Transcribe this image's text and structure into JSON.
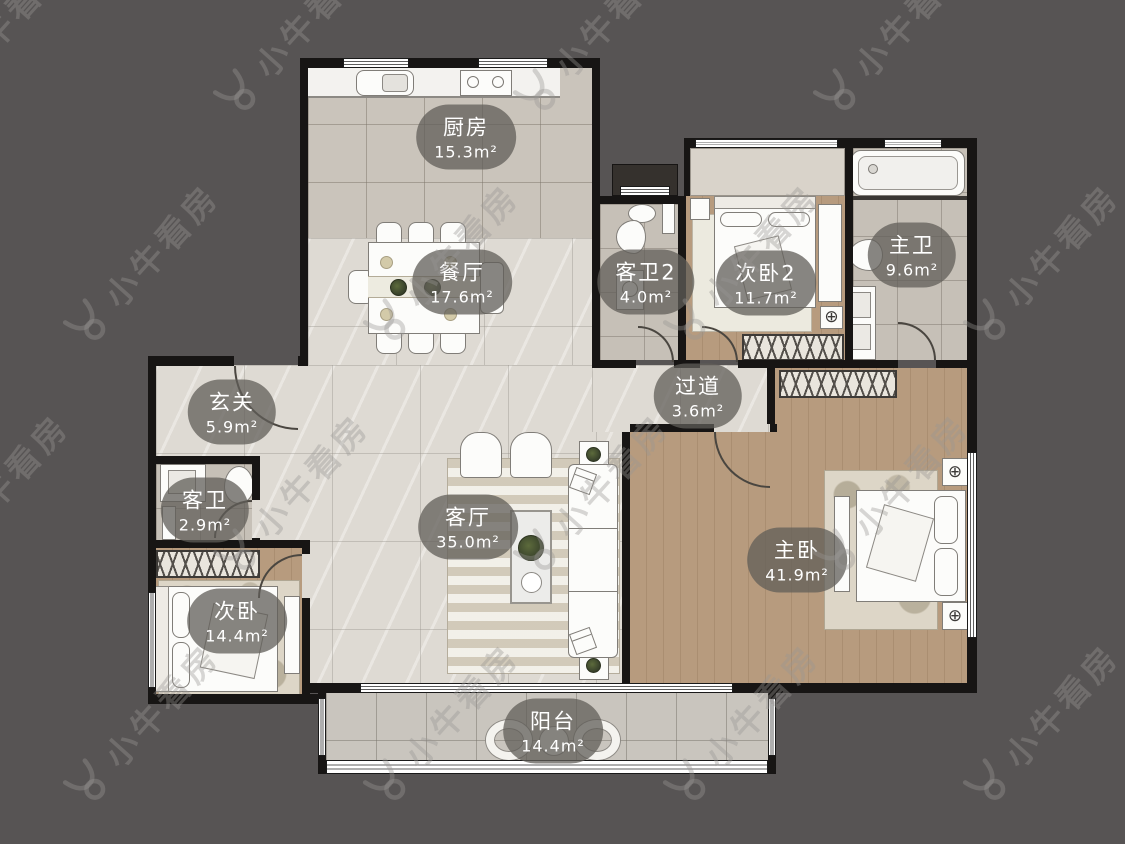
{
  "branding": {
    "watermark_text": "小牛看房"
  },
  "rooms": [
    {
      "id": "kitchen",
      "name": "厨房",
      "area": "15.3m²"
    },
    {
      "id": "dining",
      "name": "餐厅",
      "area": "17.6m²"
    },
    {
      "id": "guest-bath-2",
      "name": "客卫2",
      "area": "4.0m²"
    },
    {
      "id": "bedroom-2",
      "name": "次卧2",
      "area": "11.7m²"
    },
    {
      "id": "master-bath",
      "name": "主卫",
      "area": "9.6m²"
    },
    {
      "id": "entry",
      "name": "玄关",
      "area": "5.9m²"
    },
    {
      "id": "corridor",
      "name": "过道",
      "area": "3.6m²"
    },
    {
      "id": "guest-bath",
      "name": "客卫",
      "area": "2.9m²"
    },
    {
      "id": "living",
      "name": "客厅",
      "area": "35.0m²"
    },
    {
      "id": "master-bedroom",
      "name": "主卧",
      "area": "41.9m²"
    },
    {
      "id": "bedroom",
      "name": "次卧",
      "area": "14.4m²"
    },
    {
      "id": "balcony",
      "name": "阳台",
      "area": "14.4m²"
    }
  ],
  "colors": {
    "background": "#575454",
    "wall": "#171514",
    "wood_floor": "#b79b7e",
    "kitchen_tile": "#cac4bb",
    "marble_floor": "#dedad3",
    "label_pill": "rgba(96,93,88,0.75)"
  }
}
